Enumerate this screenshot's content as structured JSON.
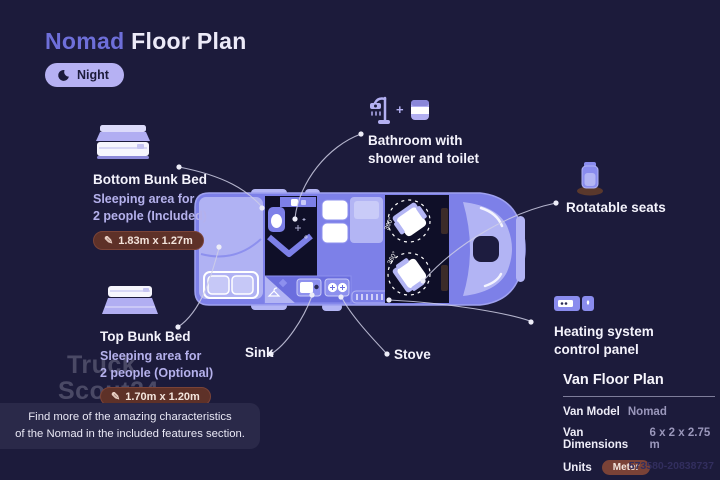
{
  "page": {
    "title_accent": "Nomad",
    "title_rest": "Floor Plan",
    "photo_id": "573580-20838737"
  },
  "mode_badge": {
    "label": "Night",
    "icon": "moon-icon"
  },
  "callouts": {
    "bottom_bunk": {
      "title": "Bottom Bunk Bed",
      "desc_line1": "Sleeping area for",
      "desc_line2": "2 people (Included)",
      "dimensions": "1.83m x 1.27m"
    },
    "top_bunk": {
      "title": "Top Bunk Bed",
      "desc_line1": "Sleeping area for",
      "desc_line2": "2 people (Optional)",
      "dimensions": "1.70m x 1.20m"
    },
    "bathroom": {
      "line1": "Bathroom with",
      "line2": "shower and toilet"
    },
    "rotatable_seats": {
      "label": "Rotatable seats"
    },
    "heating": {
      "line1": "Heating system",
      "line2": "control panel"
    },
    "sink": {
      "label": "Sink"
    },
    "stove": {
      "label": "Stove"
    },
    "plus_sign": "+"
  },
  "floor_plan": {
    "rotation_label": "360°"
  },
  "info_panel": {
    "title": "Van Floor Plan",
    "rows": [
      {
        "label": "Van Model",
        "value": "Nomad"
      },
      {
        "label": "Van Dimensions",
        "value": "6 x 2 x 2.75 m"
      },
      {
        "label": "Units",
        "value": "Meter"
      }
    ]
  },
  "footer_note": {
    "line1": "Find more of the amazing characteristics",
    "line2": "of the Nomad in the included features section."
  },
  "watermark": {
    "line1": "Truck",
    "line2": "Scout24"
  },
  "colors": {
    "background": "#1c1b3b",
    "accent_purple": "#6e6fd9",
    "night_badge_bg": "#b6b1f3",
    "dimension_badge_bg": "#5e3128",
    "meter_badge_bg": "#7a4237",
    "van_body": "#7d80e8",
    "van_light": "#b3b5f4",
    "van_dark_interior": "#0f0f28",
    "note_bg": "#2a2949"
  }
}
